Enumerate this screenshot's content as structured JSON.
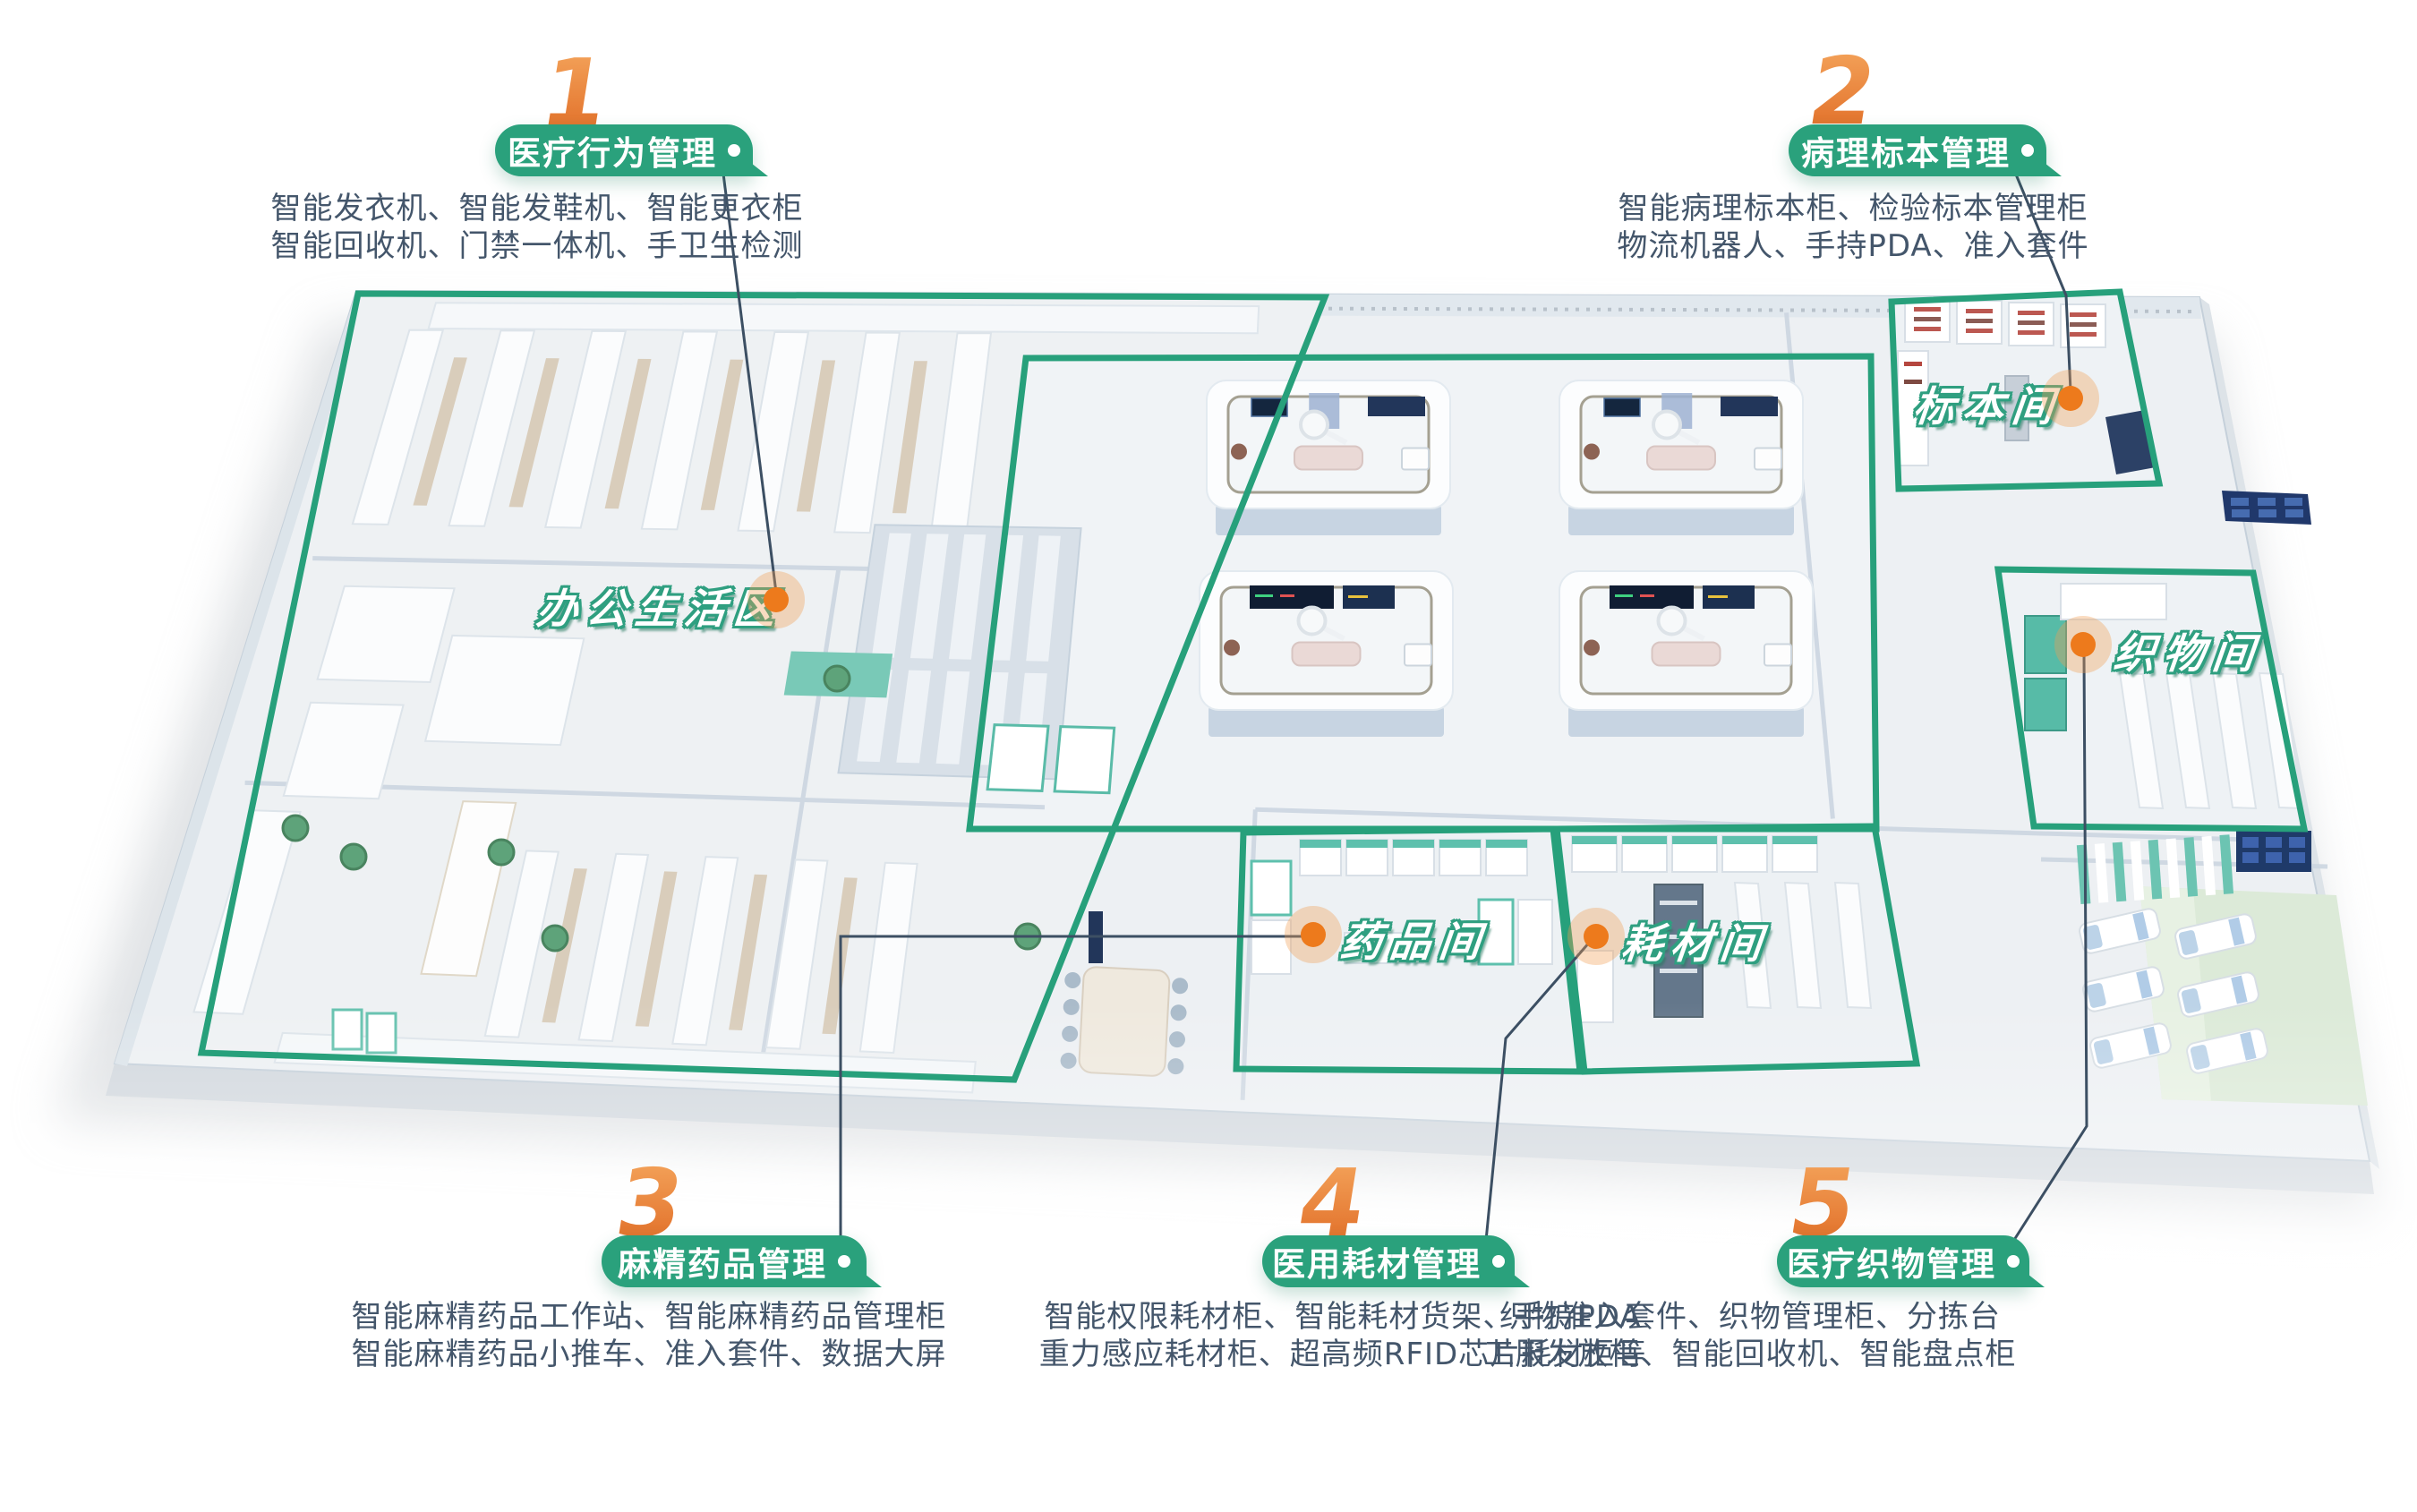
{
  "colors": {
    "badge_green": "#2AA17C",
    "zone_outline_green": "#27A07B",
    "number_orange": "#E8803B",
    "dot_orange": "#ED7A1C",
    "connector_line": "#3C4F63",
    "description_text": "#44566B"
  },
  "sections": [
    {
      "number": "1",
      "title": "医疗行为管理",
      "desc_line1": "智能发衣机、智能发鞋机、智能更衣柜",
      "desc_line2": "智能回收机、门禁一体机、手卫生检测"
    },
    {
      "number": "2",
      "title": "病理标本管理",
      "desc_line1": "智能病理标本柜、检验标本管理柜",
      "desc_line2": "物流机器人、手持PDA、准入套件"
    },
    {
      "number": "3",
      "title": "麻精药品管理",
      "desc_line1": "智能麻精药品工作站、智能麻精药品管理柜",
      "desc_line2": "智能麻精药品小推车、准入套件、数据大屏"
    },
    {
      "number": "4",
      "title": "医用耗材管理",
      "desc_line1": "智能权限耗材柜、智能耗材货架、手持PDA",
      "desc_line2": "重力感应耗材柜、超高频RFID芯片耗材柜等"
    },
    {
      "number": "5",
      "title": "医疗织物管理",
      "desc_line1": "织物准入套件、织物管理柜、分拣台",
      "desc_line2": "工服发放柜、智能回收机、智能盘点柜"
    }
  ],
  "room_labels": [
    {
      "name": "办公生活区"
    },
    {
      "name": "标本间"
    },
    {
      "name": "织物间"
    },
    {
      "name": "药品间"
    },
    {
      "name": "耗材间"
    }
  ]
}
